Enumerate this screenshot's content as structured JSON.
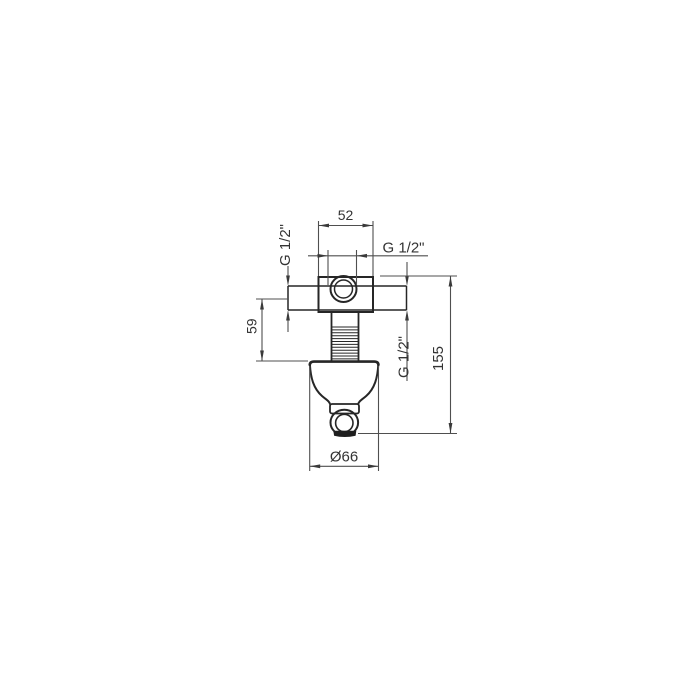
{
  "drawing": {
    "kind": "technical drawing of wall-mounted valve / shower outlet elbow",
    "colors": {
      "background": "#ffffff",
      "object_line": "#262626",
      "dimension_line": "#4f4f4f",
      "text": "#333333"
    },
    "dims": {
      "width": "52",
      "offset": "59",
      "height": "155",
      "diameter": "Ø66",
      "thread_top": "G 1/2\"",
      "thread_left": "G 1/2\"",
      "thread_right": "G 1/2\""
    }
  }
}
